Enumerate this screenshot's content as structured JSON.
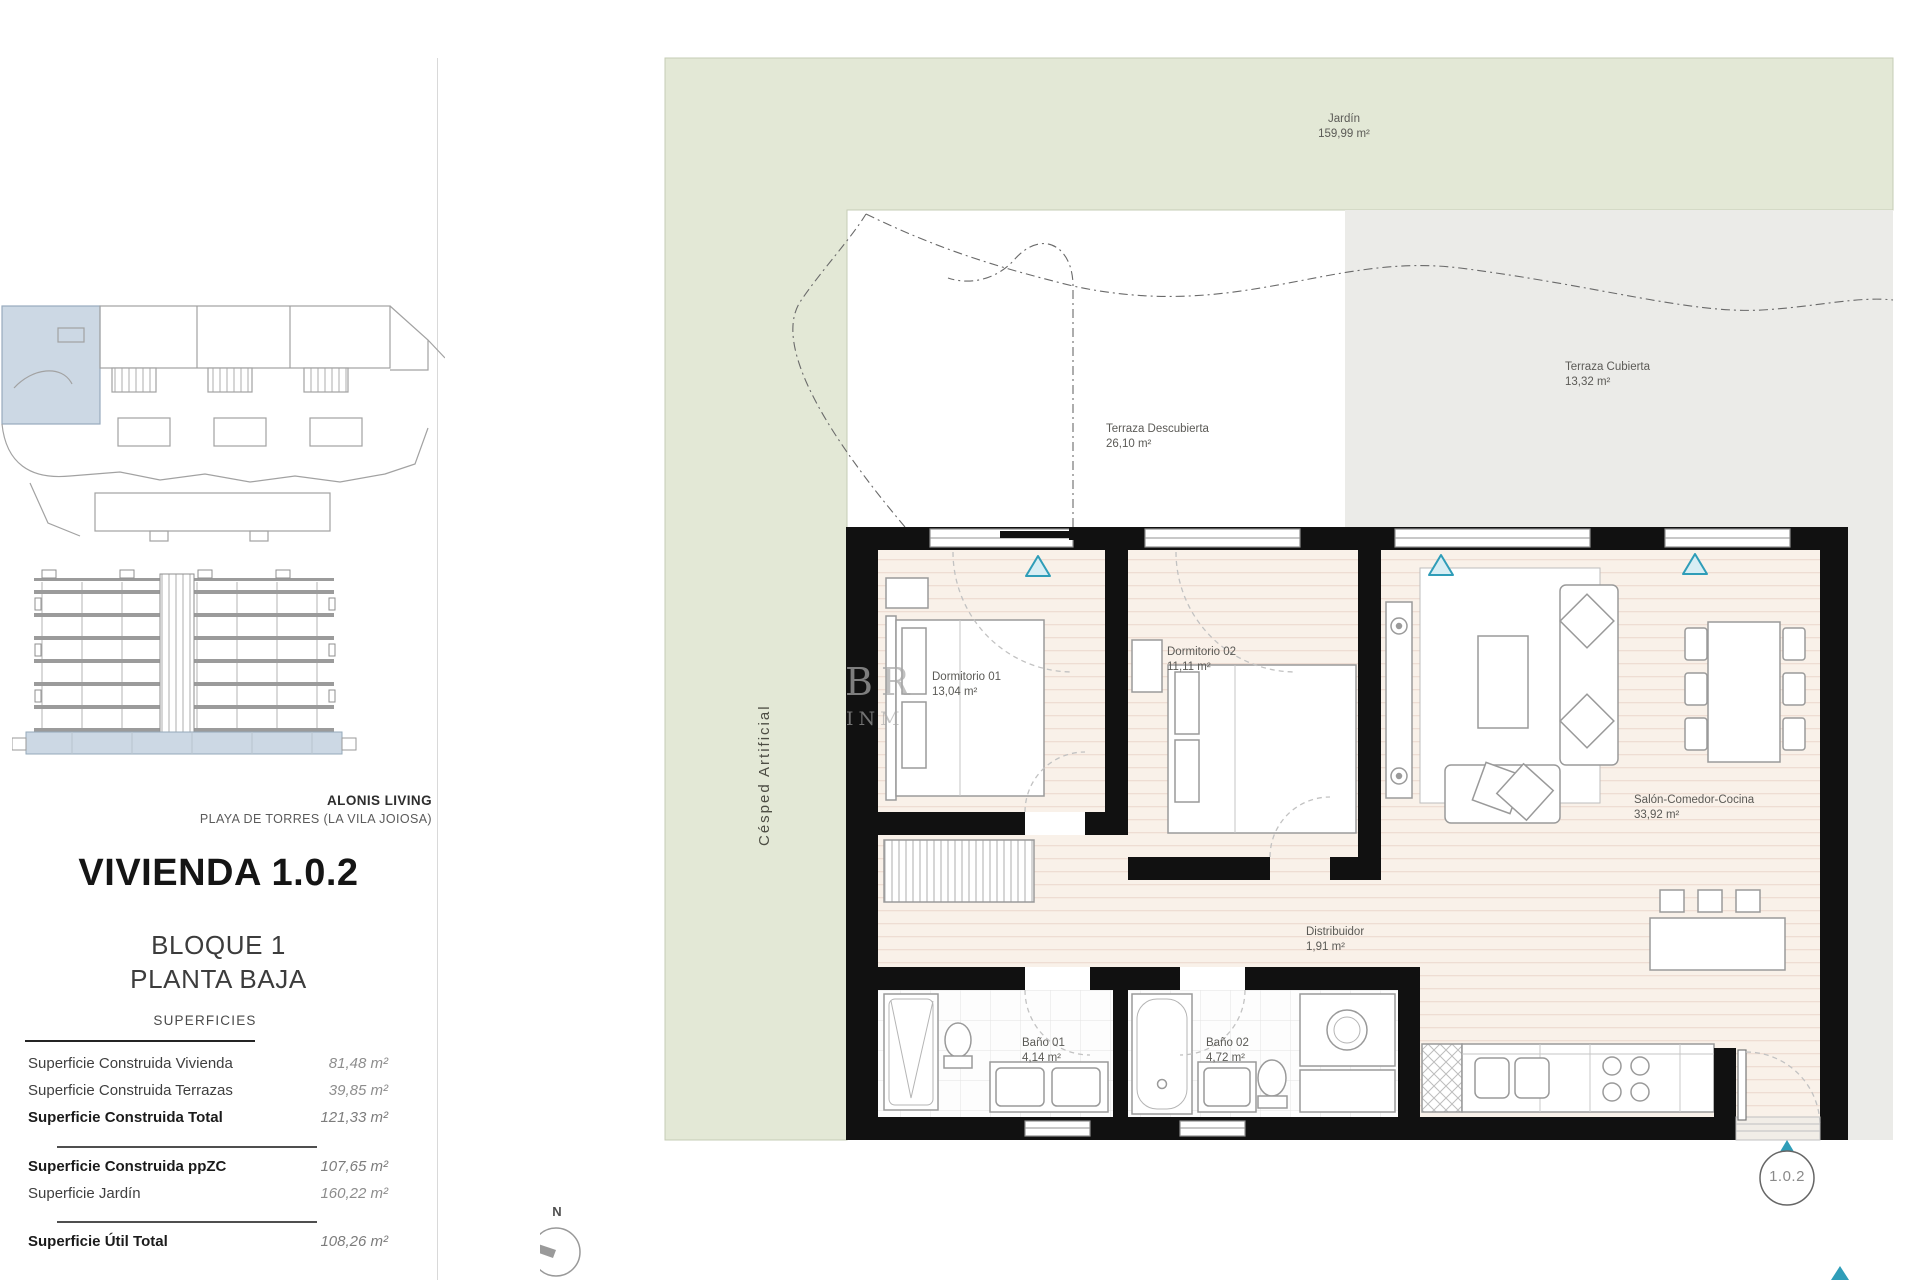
{
  "sidebar": {
    "project_name": "ALONIS LIVING",
    "project_location": "PLAYA DE TORRES (LA VILA JOIOSA)",
    "unit_title": "VIVIENDA 1.0.2",
    "block_line1": "BLOQUE 1",
    "block_line2": "PLANTA BAJA",
    "table_title": "SUPERFICIES",
    "rows": [
      {
        "label": "Superficie Construida Vivienda",
        "value": "81,48 m²",
        "bold": false
      },
      {
        "label": "Superficie Construida Terrazas",
        "value": "39,85 m²",
        "bold": false
      },
      {
        "label": "Superficie Construida Total",
        "value": "121,33 m²",
        "bold": true
      },
      {
        "label": "Superficie Construida ppZC",
        "value": "107,65 m²",
        "bold": true
      },
      {
        "label": "Superficie Jardín",
        "value": "160,22 m²",
        "bold": false
      },
      {
        "label": "Superficie Útil Total",
        "value": "108,26 m²",
        "bold": true
      }
    ]
  },
  "plan": {
    "garden": {
      "name": "Jardín",
      "area": "159,99 m²"
    },
    "covered_terrace": {
      "name": "Terraza Cubierta",
      "area": "13,32 m²"
    },
    "open_terrace": {
      "name": "Terraza Descubierta",
      "area": "26,10 m²"
    },
    "artificial_grass": {
      "name": "Césped Artificial"
    },
    "bedroom1": {
      "name": "Dormitorio 01",
      "area": "13,04 m²"
    },
    "bedroom2": {
      "name": "Dormitorio 02",
      "area": "11,11 m²"
    },
    "living": {
      "name": "Salón-Comedor-Cocina",
      "area": "33,92 m²"
    },
    "hall": {
      "name": "Distribuidor",
      "area": "1,91 m²"
    },
    "bath1": {
      "name": "Baño 01",
      "area": "4,14 m²"
    },
    "bath2": {
      "name": "Baño 02",
      "area": "4,72 m²"
    },
    "unit_badge": "1.0.2",
    "compass": "N",
    "watermark_line1": "BR",
    "watermark_line2": "INM"
  },
  "colors": {
    "garden_green": "#e3e8d6",
    "terrace_gray": "#ebebe8",
    "floor_cream": "#f9f1e9",
    "wall_black": "#111111",
    "accent_teal": "#2f9db8",
    "highlight_blue": "#ccd8e4"
  }
}
